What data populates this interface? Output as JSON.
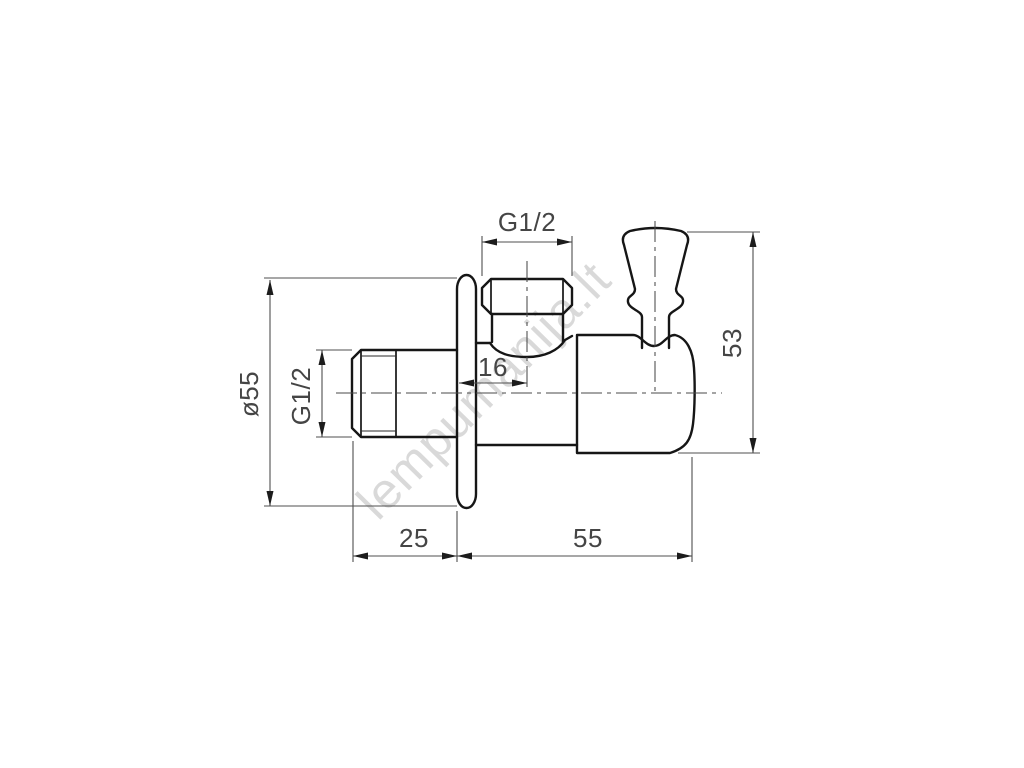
{
  "watermark": {
    "text": "lempumanija.lt",
    "color": "#d8d8d8"
  },
  "drawing": {
    "type": "technical-drawing",
    "subject": "angle-valve-side-view-with-wall-flange-and-handle",
    "colors": {
      "outline": "#161616",
      "dimension": "#4f4f4f",
      "background": "#ffffff"
    },
    "labels": {
      "top_port_thread": "G1/2",
      "port_offset": "16",
      "overall_height": "53",
      "flange_diameter": "ø55",
      "inlet_thread": "G1/2",
      "inlet_length": "25",
      "body_length": "55"
    }
  }
}
